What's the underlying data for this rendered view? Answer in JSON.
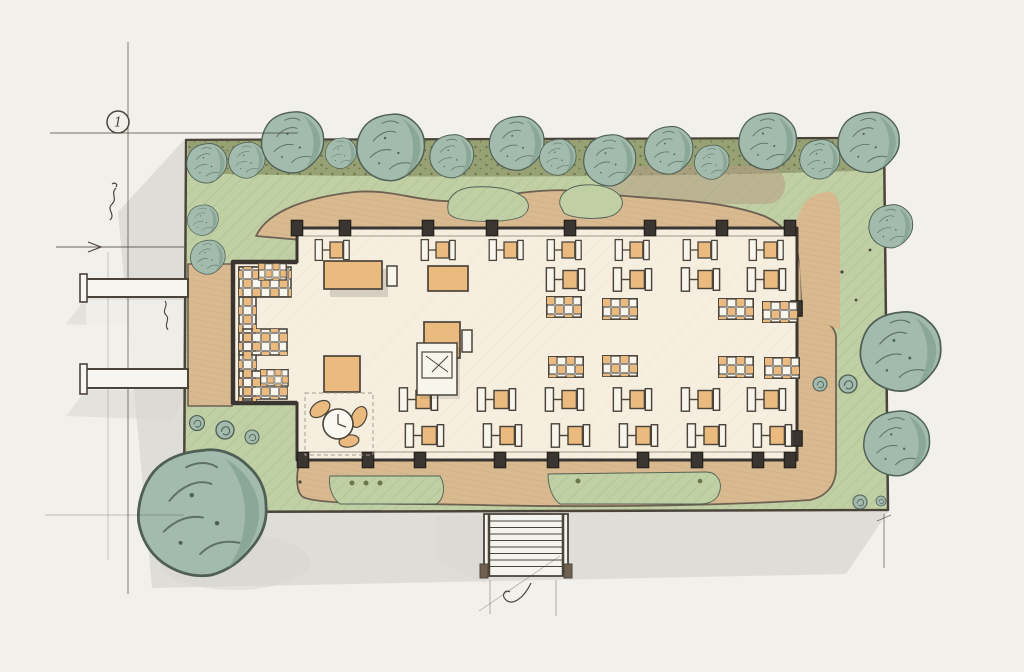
{
  "annotations": {
    "grid_marker": "1"
  },
  "palette": {
    "paper": "#f2f0ea",
    "shadow": "#d8d7d2",
    "lawn": "#c0d0a4",
    "lawn_hatch": "#93ad77",
    "hedge": "#97a173",
    "hedge_dot": "#6b774a",
    "mulch": "#b49d85",
    "tree": "#a2bbac",
    "tree_shade": "#82a090",
    "tree_line": "#4f5f55",
    "deck": "#d8b990",
    "deck_line": "#bd9c72",
    "deck_edge": "#6f6152",
    "wall": "#3a3530",
    "floor": "#f6efdf",
    "floor_line": "#e2d4b9",
    "tan": "#eaba7e",
    "white_furn": "#f8f5ed",
    "ink": "#4b443b"
  }
}
